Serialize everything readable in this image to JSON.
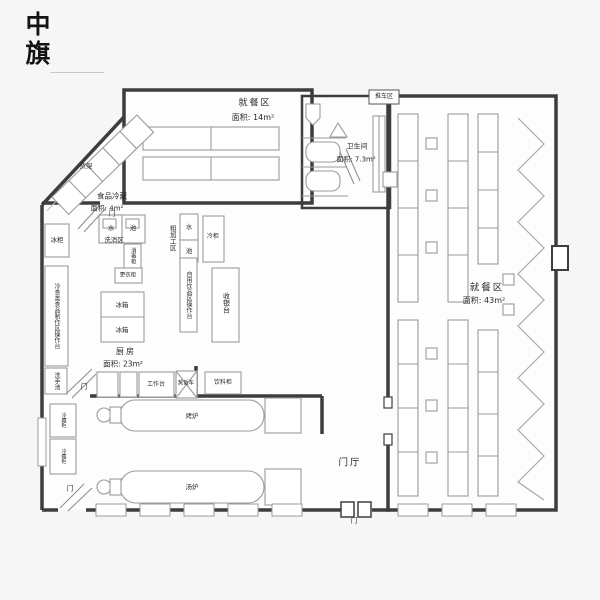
{
  "logo": "中旗",
  "rooms": {
    "dining_small": {
      "name": "就餐区",
      "area": "面积: 14m²"
    },
    "restroom": {
      "name": "卫生间",
      "area": "面积: 7.3m²"
    },
    "dining_large": {
      "name": "就餐区",
      "area": "面积: 43m²"
    },
    "cold_storage": {
      "name": "食品冷藏",
      "area": "面积: 4m²"
    },
    "kitchen": {
      "name": "厨房",
      "area": "面积: 23m²"
    },
    "foyer": {
      "name": "门厅"
    }
  },
  "fixtures": {
    "cart_stand": "推车区",
    "shelf": "货架",
    "freezer": "冰柜",
    "cold_food_counter": "冷食类食品制作区操作台",
    "hand_sink": "洗手池",
    "water": "水",
    "basin": "池",
    "wash_area": "洗消区",
    "sanitizer_cabinet": "消毒柜",
    "locker": "更衣柜",
    "rough_processing": "粗加工区",
    "cold_cabinet": "冷柜",
    "beverage_counter": "自用饮品区操作台",
    "cashier": "收银台",
    "fridge": "冰箱",
    "worktable": "工作台",
    "rice_steamer": "蒸饭车",
    "drink_cabinet": "饮料柜",
    "roast_oven": "烤炉",
    "soup_stove": "汤炉",
    "cold_display": "冷藏柜",
    "door": "门"
  },
  "colors": {
    "wall": "#3d3d3d",
    "furniture": "#9b9b9b",
    "background": "#f6f6f6",
    "floor": "#fdfdfd",
    "text": "#2b2b2b"
  }
}
